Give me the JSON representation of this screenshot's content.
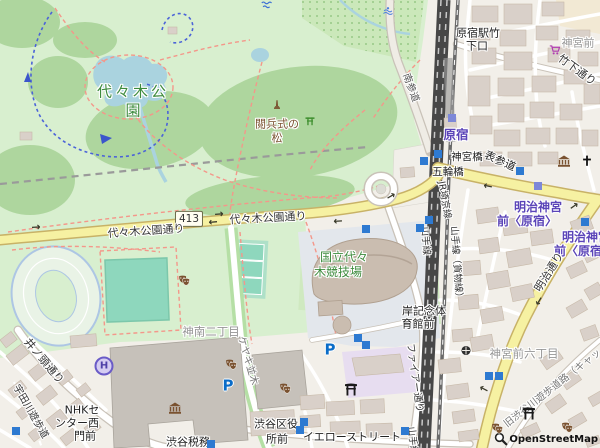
{
  "attribution": {
    "text": "OpenStreetMap"
  },
  "shield": {
    "number": "413"
  },
  "colors": {
    "park_green": "#d8efcf",
    "forest_green": "#aed69e",
    "pitch_teal": "#8ed7bd",
    "water_blue": "#aad3df",
    "road_yellow": "#f6f1a2",
    "railway_dark": "#474747",
    "building_tan": "#d9d0c9",
    "building_gray": "#c6c1ba",
    "station_purple": "#5b44b8",
    "subway_blue": "#2e7ad1",
    "path_red": "#f4978a",
    "label_green": "#3d8b3d",
    "label_brown": "#7a5230",
    "district_gray": "#969696"
  },
  "map": {
    "labels": [
      {
        "name": "label-yoyogi-park-line1",
        "text": "代々木公",
        "x": 133,
        "y": 92,
        "size": 15,
        "color": "#3d8b3d",
        "spacing": 3
      },
      {
        "name": "label-yoyogi-park-line2",
        "text": "園",
        "x": 133,
        "y": 111,
        "size": 15,
        "color": "#3d8b3d"
      },
      {
        "name": "label-eppeishiki-pine-line1",
        "text": "閲兵式の",
        "x": 277,
        "y": 124,
        "size": 11,
        "color": "#7a5230"
      },
      {
        "name": "label-eppeishiki-pine-line2",
        "text": "松",
        "x": 277,
        "y": 138,
        "size": 11,
        "color": "#7a5230"
      },
      {
        "name": "label-yoyogi-koen-dori-west",
        "text": "代々木公園通り",
        "x": 146,
        "y": 231,
        "size": 11,
        "color": "#333333",
        "rot": -4
      },
      {
        "name": "label-yoyogi-koen-dori",
        "text": "代々木公園通り",
        "x": 268,
        "y": 218,
        "size": 11,
        "color": "#333333",
        "rot": -3
      },
      {
        "name": "label-harajuku-takeshita-exit-1",
        "text": "原宿駅竹",
        "x": 478,
        "y": 33,
        "size": 11,
        "color": "#222222"
      },
      {
        "name": "label-harajuku-takeshita-exit-2",
        "text": "下口",
        "x": 477,
        "y": 46,
        "size": 11,
        "color": "#222222"
      },
      {
        "name": "label-jingumae",
        "text": "神宮前",
        "x": 578,
        "y": 43,
        "size": 11,
        "color": "#969696"
      },
      {
        "name": "label-takeshita-street",
        "text": "竹下通り",
        "x": 577,
        "y": 70,
        "size": 11,
        "color": "#333333",
        "rot": 36
      },
      {
        "name": "label-minami-sando",
        "text": "南参道",
        "x": 410,
        "y": 88,
        "size": 10,
        "color": "#555555",
        "rot": 70
      },
      {
        "name": "label-harajuku-station",
        "text": "原宿",
        "x": 456,
        "y": 135,
        "size": 12.5,
        "color": "#5b44b8",
        "bold": true
      },
      {
        "name": "label-jingubashi",
        "text": "神宮橋",
        "x": 467,
        "y": 157,
        "size": 10.5,
        "color": "#222222"
      },
      {
        "name": "label-omotesando",
        "text": "表参道",
        "x": 500,
        "y": 161,
        "size": 11,
        "color": "#222222",
        "rot": 24
      },
      {
        "name": "label-gorinbashi",
        "text": "五輪橋",
        "x": 448,
        "y": 172,
        "size": 10.5,
        "color": "#222222"
      },
      {
        "name": "label-meijijingumae-1a",
        "text": "明治神宮",
        "x": 538,
        "y": 207,
        "size": 12,
        "color": "#5b44b8",
        "bold": true
      },
      {
        "name": "label-meijijingumae-1b",
        "text": "前〈原宿〉",
        "x": 527,
        "y": 221,
        "size": 12,
        "color": "#5b44b8",
        "bold": true
      },
      {
        "name": "label-meijijingumae-2a",
        "text": "明治神宮",
        "x": 586,
        "y": 237,
        "size": 12,
        "color": "#5b44b8",
        "bold": true
      },
      {
        "name": "label-meijijingumae-2b",
        "text": "前〈原宿〉",
        "x": 584,
        "y": 251,
        "size": 12,
        "color": "#5b44b8",
        "bold": true
      },
      {
        "name": "label-meiji-dori",
        "text": "明治通り",
        "x": 549,
        "y": 272,
        "size": 11,
        "color": "#333333",
        "rot": -58
      },
      {
        "name": "label-jr-saikyo-line",
        "text": "JR埼京線",
        "x": 444,
        "y": 200,
        "size": 9.5,
        "color": "#333333",
        "rot": 80
      },
      {
        "name": "label-yamanote-line",
        "text": "山手線",
        "x": 425,
        "y": 241,
        "size": 9.5,
        "color": "#333333",
        "rot": 86
      },
      {
        "name": "label-yamanote-freight-line",
        "text": "山手線（貨物線）",
        "x": 456,
        "y": 264,
        "size": 9.5,
        "color": "#333333",
        "rot": 86
      },
      {
        "name": "label-yamanote-line-south",
        "text": "山手線",
        "x": 412,
        "y": 441,
        "size": 9.5,
        "color": "#333333",
        "rot": 84
      },
      {
        "name": "label-yoyogi-stadium-1",
        "text": "国立代々",
        "x": 344,
        "y": 257,
        "size": 12,
        "color": "#3d8b3d"
      },
      {
        "name": "label-yoyogi-stadium-2",
        "text": "木競技場",
        "x": 338,
        "y": 272,
        "size": 12,
        "color": "#3d8b3d"
      },
      {
        "name": "label-kishi-gym-1",
        "text": "岸記念体",
        "x": 424,
        "y": 311,
        "size": 11,
        "color": "#222222"
      },
      {
        "name": "label-kishi-gym-2",
        "text": "育館前",
        "x": 418,
        "y": 324,
        "size": 11,
        "color": "#222222"
      },
      {
        "name": "label-jinnan-2chome",
        "text": "神南二丁目",
        "x": 211,
        "y": 332,
        "size": 11.5,
        "color": "#969696"
      },
      {
        "name": "label-keyaki-namiki",
        "text": "ケヤキ並木",
        "x": 247,
        "y": 361,
        "size": 10,
        "color": "#777777",
        "rot": 74
      },
      {
        "name": "label-inokashira-dori",
        "text": "井ノ頭通り",
        "x": 44,
        "y": 361,
        "size": 11,
        "color": "#333333",
        "rot": 50
      },
      {
        "name": "label-udagawa-promenade",
        "text": "宇田川遊歩道",
        "x": 30,
        "y": 412,
        "size": 10,
        "color": "#333333",
        "rot": 60
      },
      {
        "name": "label-nhk-center-1",
        "text": "NHKセ",
        "x": 82,
        "y": 410,
        "size": 11,
        "color": "#222222"
      },
      {
        "name": "label-nhk-center-2",
        "text": "ンター西",
        "x": 77,
        "y": 423,
        "size": 11,
        "color": "#222222"
      },
      {
        "name": "label-nhk-center-3",
        "text": "門前",
        "x": 85,
        "y": 436,
        "size": 11,
        "color": "#222222"
      },
      {
        "name": "label-shibuya-ward-office-1",
        "text": "渋谷区役",
        "x": 276,
        "y": 424,
        "size": 11,
        "color": "#222222"
      },
      {
        "name": "label-shibuya-ward-office-2",
        "text": "所前",
        "x": 277,
        "y": 439,
        "size": 11,
        "color": "#222222"
      },
      {
        "name": "label-shibuya-tax-office",
        "text": "渋谷税務",
        "x": 188,
        "y": 442,
        "size": 11,
        "color": "#222222"
      },
      {
        "name": "label-yellow-street",
        "text": "イエローストリート",
        "x": 352,
        "y": 437,
        "size": 11,
        "color": "#222222"
      },
      {
        "name": "label-jingumae-6chome",
        "text": "神宮前六丁目",
        "x": 524,
        "y": 354,
        "size": 11.5,
        "color": "#969696"
      },
      {
        "name": "label-old-shibuya-river-path",
        "text": "旧渋谷川遊歩道路（キャッ",
        "x": 553,
        "y": 389,
        "size": 10,
        "color": "#777777",
        "rot": -38
      },
      {
        "name": "label-fire-street",
        "text": "ファイアー通り",
        "x": 414,
        "y": 378,
        "size": 10,
        "color": "#333333",
        "rot": 82
      }
    ],
    "icons": [
      {
        "type": "monument",
        "x": 277,
        "y": 106
      },
      {
        "type": "picnic",
        "x": 310,
        "y": 122
      },
      {
        "type": "fountain",
        "x": 388,
        "y": 13
      },
      {
        "type": "wave",
        "x": 267,
        "y": 7
      },
      {
        "type": "museum",
        "x": 175,
        "y": 410
      },
      {
        "type": "museum",
        "x": 564,
        "y": 163
      },
      {
        "type": "masks",
        "x": 184,
        "y": 282
      },
      {
        "type": "masks",
        "x": 231,
        "y": 366
      },
      {
        "type": "masks",
        "x": 285,
        "y": 390
      },
      {
        "type": "masks",
        "x": 497,
        "y": 430
      },
      {
        "type": "masks",
        "x": 567,
        "y": 429
      },
      {
        "type": "torii",
        "x": 351,
        "y": 391
      },
      {
        "type": "torii",
        "x": 529,
        "y": 415
      },
      {
        "type": "cross",
        "x": 587,
        "y": 162
      },
      {
        "type": "cart",
        "x": 555,
        "y": 52
      },
      {
        "type": "shrine",
        "x": 466,
        "y": 352
      },
      {
        "type": "helipad",
        "x": 104,
        "y": 366,
        "glyph": "H"
      },
      {
        "type": "parking",
        "x": 228,
        "y": 386,
        "glyph": "P"
      },
      {
        "type": "parking",
        "x": 330,
        "y": 350,
        "glyph": "P"
      },
      {
        "type": "subway",
        "x": 452,
        "y": 118,
        "muted": true
      },
      {
        "type": "subway",
        "x": 438,
        "y": 154
      },
      {
        "type": "subway",
        "x": 424,
        "y": 161
      },
      {
        "type": "subway",
        "x": 520,
        "y": 171
      },
      {
        "type": "subway",
        "x": 538,
        "y": 186,
        "muted": true
      },
      {
        "type": "subway",
        "x": 585,
        "y": 222
      },
      {
        "type": "subway",
        "x": 429,
        "y": 220
      },
      {
        "type": "subway",
        "x": 420,
        "y": 228
      },
      {
        "type": "subway",
        "x": 366,
        "y": 229
      },
      {
        "type": "subway",
        "x": 358,
        "y": 338
      },
      {
        "type": "subway",
        "x": 366,
        "y": 345
      },
      {
        "type": "subway",
        "x": 489,
        "y": 376
      },
      {
        "type": "subway",
        "x": 499,
        "y": 376
      },
      {
        "type": "subway",
        "x": 304,
        "y": 422
      },
      {
        "type": "subway",
        "x": 300,
        "y": 430
      },
      {
        "type": "subway",
        "x": 405,
        "y": 431
      },
      {
        "type": "subway",
        "x": 211,
        "y": 444
      },
      {
        "type": "subway",
        "x": 16,
        "y": 431
      }
    ],
    "arrows": [
      {
        "g": "→",
        "x": 219,
        "y": 214,
        "rot": -5
      },
      {
        "g": "←",
        "x": 213,
        "y": 222,
        "rot": -5
      },
      {
        "g": "←",
        "x": 338,
        "y": 221,
        "rot": -4
      },
      {
        "g": "→",
        "x": 36,
        "y": 227,
        "rot": -4
      },
      {
        "g": "←",
        "x": 488,
        "y": 186,
        "rot": 12
      },
      {
        "g": "→",
        "x": 391,
        "y": 196,
        "rot": -30
      },
      {
        "g": "→",
        "x": 574,
        "y": 206,
        "rot": -35
      },
      {
        "g": "←",
        "x": 539,
        "y": 301,
        "rot": -58
      },
      {
        "g": "←",
        "x": 484,
        "y": 389,
        "rot": 28
      }
    ]
  }
}
